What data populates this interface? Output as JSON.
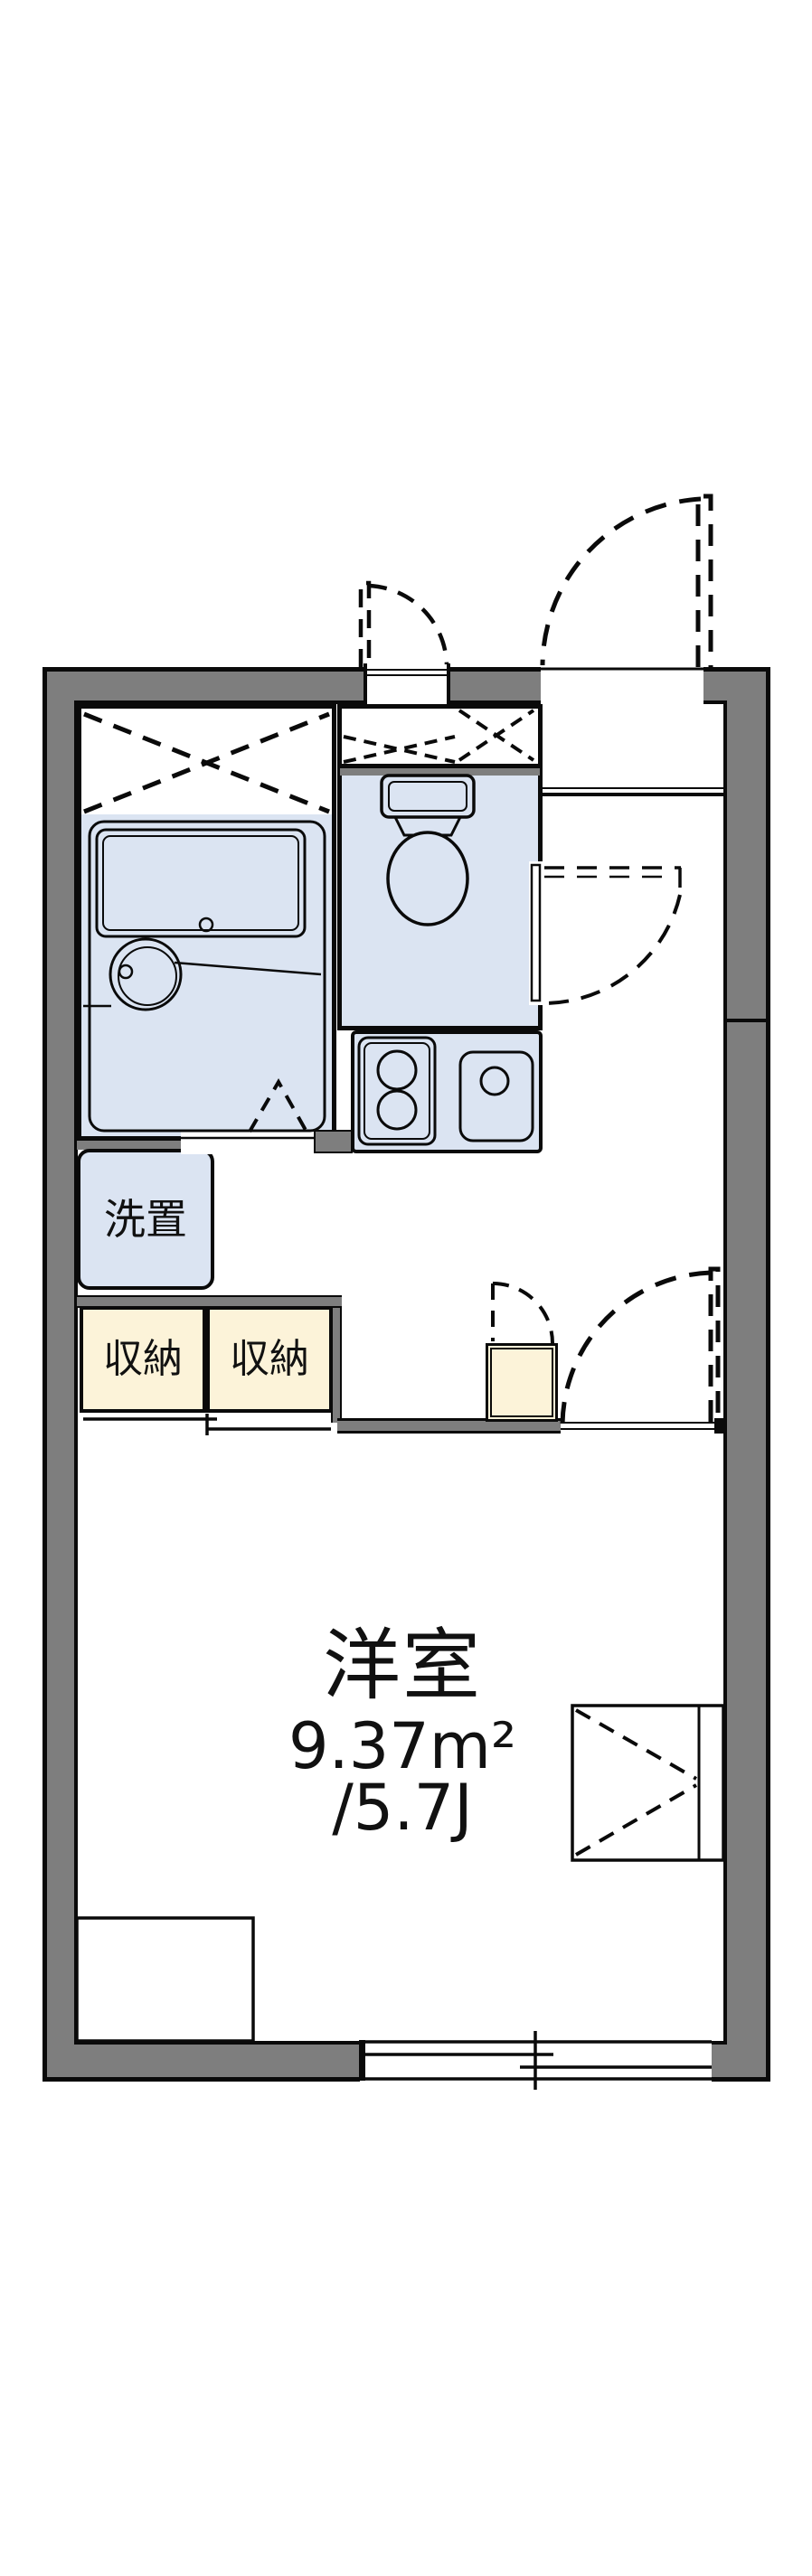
{
  "floorplan": {
    "labels": {
      "washer_space": "洗置",
      "storage_left": "収納",
      "storage_right": "収納",
      "room_name": "洋室",
      "room_area_m2": "9.37m²",
      "room_area_tatami": "/5.7J"
    },
    "colors": {
      "wall_gray": "#7e7e7e",
      "wet_area_blue": "#dbe4f2",
      "storage_cream": "#fcf3d9",
      "line_black": "#0a0a0a",
      "background": "#ffffff"
    },
    "fixtures": [
      "bathtub",
      "washbasin",
      "bathroom-folding-door",
      "toilet",
      "gas-stove",
      "kitchen-sink",
      "washing-machine-space",
      "storage-closet",
      "sliding-closet-door",
      "water-heater-box",
      "entrance-door",
      "meter-box",
      "toilet-door",
      "room-door",
      "sliding-window",
      "counter-unit",
      "low-counter"
    ]
  }
}
